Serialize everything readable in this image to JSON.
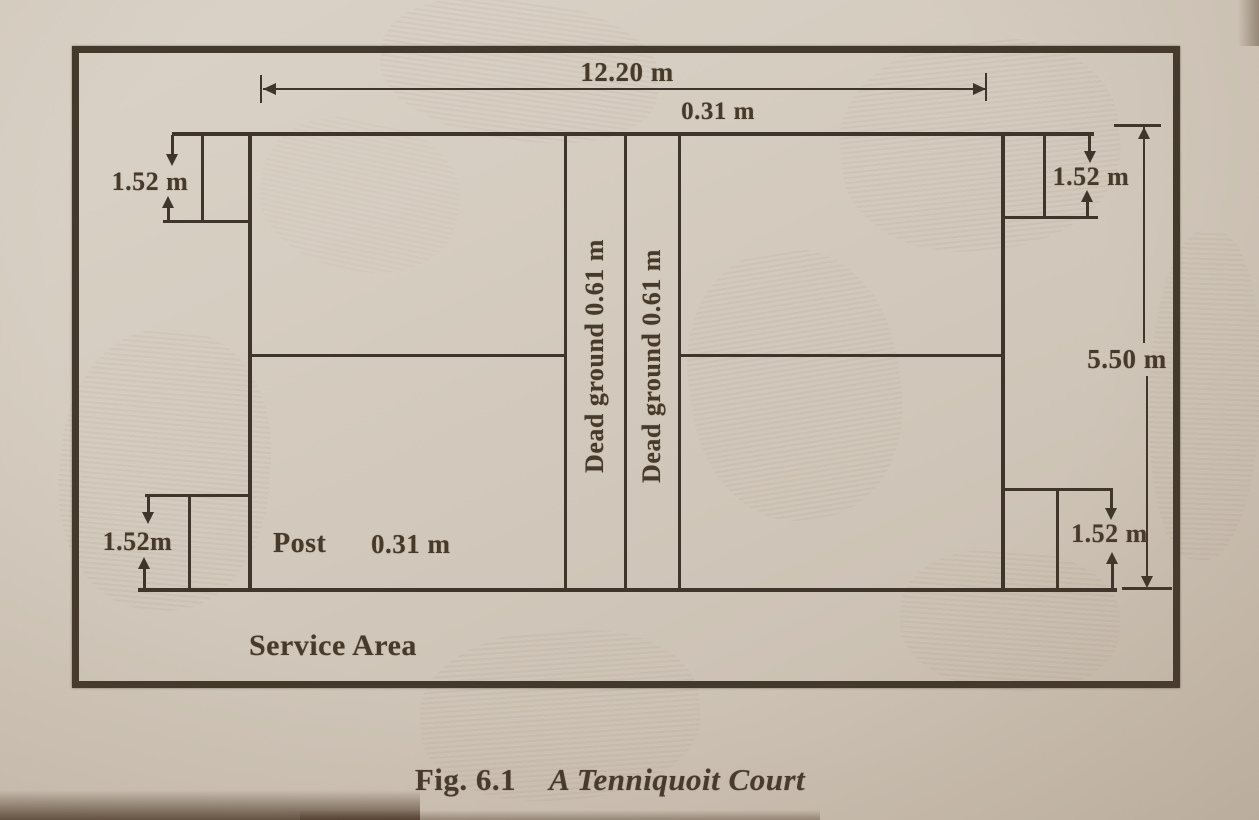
{
  "figure": {
    "length_label": "12.20 m",
    "top_offset_label": "0.31 m",
    "width_label": "5.50 m",
    "corner_tl_label": "1.52 m",
    "corner_tr_label": "1.52 m",
    "corner_bl_label": "1.52m",
    "corner_br_label": "1.52 m",
    "dead_ground_left_label": "Dead ground 0.61 m",
    "dead_ground_right_label": "Dead ground 0.61 m",
    "post_label": "Post",
    "post_width_label": "0.31 m",
    "service_area_label": "Service Area",
    "caption_fig": "Fig.  6.1",
    "caption_title": "A Tenniquoit Court"
  }
}
